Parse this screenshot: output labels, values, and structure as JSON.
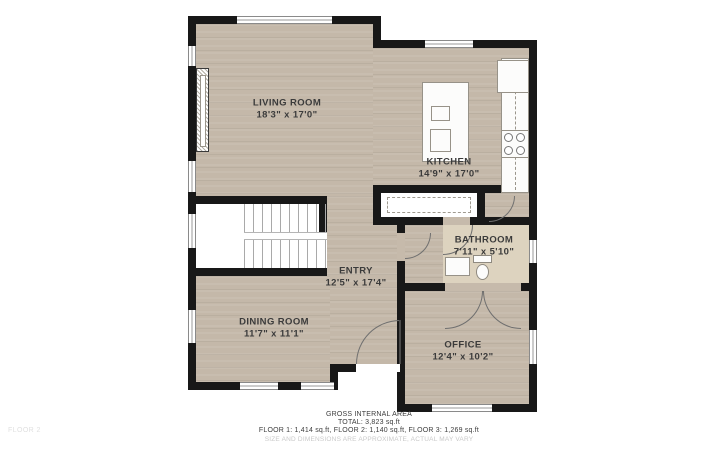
{
  "plan": {
    "floor_watermark": "FLOOR 2",
    "colors": {
      "wall": "#181818",
      "wood_floor": "#c4b8a9",
      "tile_floor": "#ddd3bf",
      "background": "#ffffff",
      "label_text": "#3b3b3b",
      "disclaimer_text": "#c9c9c9"
    }
  },
  "rooms": [
    {
      "name": "LIVING ROOM",
      "dimensions": "18'3\" x 17'0\""
    },
    {
      "name": "KITCHEN",
      "dimensions": "14'9\" x 17'0\""
    },
    {
      "name": "ENTRY",
      "dimensions": "12'5\" x 17'4\""
    },
    {
      "name": "BATHROOM",
      "dimensions": "7'11\" x 5'10\""
    },
    {
      "name": "DINING ROOM",
      "dimensions": "11'7\" x 11'1\""
    },
    {
      "name": "OFFICE",
      "dimensions": "12'4\" x 10'2\""
    }
  ],
  "summary": {
    "title": "GROSS INTERNAL AREA",
    "total": "TOTAL: 3,823 sq.ft",
    "floors": "FLOOR 1: 1,414 sq.ft, FLOOR 2: 1,140 sq.ft, FLOOR 3: 1,269 sq.ft",
    "disclaimer": "SIZE AND DIMENSIONS ARE APPROXIMATE, ACTUAL MAY VARY"
  }
}
